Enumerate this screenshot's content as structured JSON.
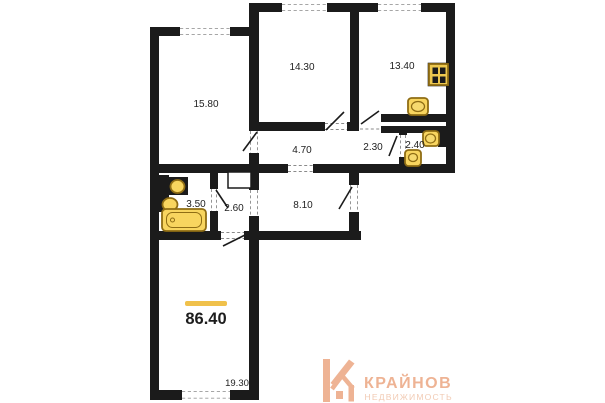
{
  "plan": {
    "total_area": "86.40",
    "rooms": [
      {
        "key": "room-top-left",
        "area": "15.80"
      },
      {
        "key": "room-top-middle",
        "area": "14.30"
      },
      {
        "key": "kitchen",
        "area": "13.40"
      },
      {
        "key": "hallway-main",
        "area": "4.70"
      },
      {
        "key": "hallway-small",
        "area": "2.30"
      },
      {
        "key": "wc",
        "area": "2.40"
      },
      {
        "key": "bathroom",
        "area": "3.50"
      },
      {
        "key": "hallway-inner",
        "area": "2.60"
      },
      {
        "key": "corridor",
        "area": "8.10"
      },
      {
        "key": "room-bottom",
        "area": "19.30"
      }
    ],
    "fixtures": [
      "bathtub",
      "sink",
      "sink",
      "sink",
      "stove",
      "toilet",
      "sink"
    ],
    "colors": {
      "wall": "#1b1b1b",
      "fixture_fill": "#f8d55f",
      "fixture_stroke": "#8f6d14",
      "accent_bar": "#f0c14b"
    }
  },
  "logo": {
    "title": "КРАЙНОВ",
    "subtitle": "НЕДВИЖИМОСТЬ",
    "title_color": "#eeb394",
    "subtitle_color": "#f2cbb4"
  }
}
